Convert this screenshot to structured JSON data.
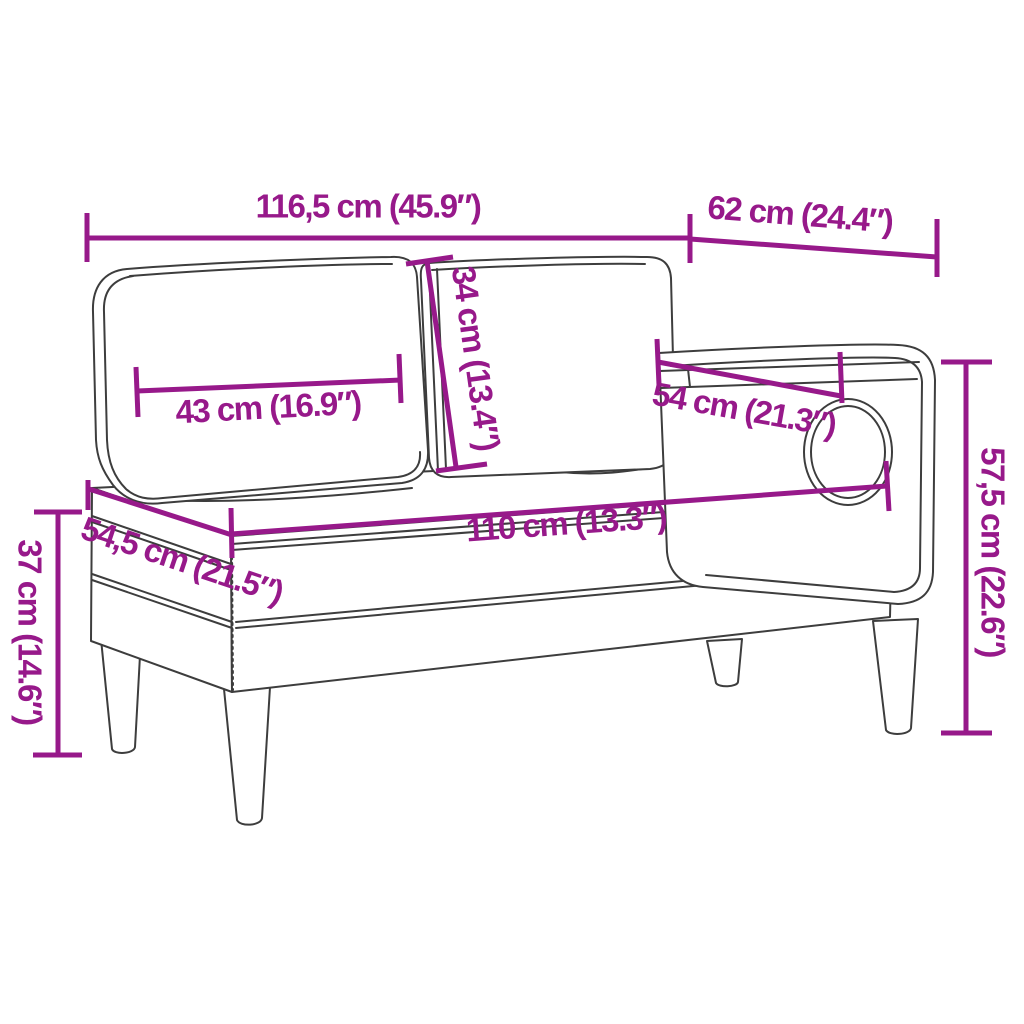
{
  "figure": {
    "type": "product-dimension-diagram",
    "subject": "chaise-longue-with-cushions-and-bolster",
    "colors": {
      "dimension": "#97198A",
      "outline": "#3D3D3D",
      "background": "#FFFFFF"
    },
    "dimensions": [
      {
        "name": "overall-width",
        "label": "116,5 cm (45.9″)"
      },
      {
        "name": "top-depth",
        "label": "62 cm (24.4″)"
      },
      {
        "name": "back-cushion-height",
        "label": "34 cm (13.4″)"
      },
      {
        "name": "back-cushion-width",
        "label": "43 cm (16.9″)"
      },
      {
        "name": "armrest-length",
        "label": "54 cm (21.3″)"
      },
      {
        "name": "total-height",
        "label": "57,5 cm (22.6″)"
      },
      {
        "name": "seat-length",
        "label": "110 cm (13.3″)"
      },
      {
        "name": "seat-depth",
        "label": "54,5 cm (21.5″)"
      },
      {
        "name": "base-height",
        "label": "37 cm (14.6″)"
      }
    ]
  }
}
